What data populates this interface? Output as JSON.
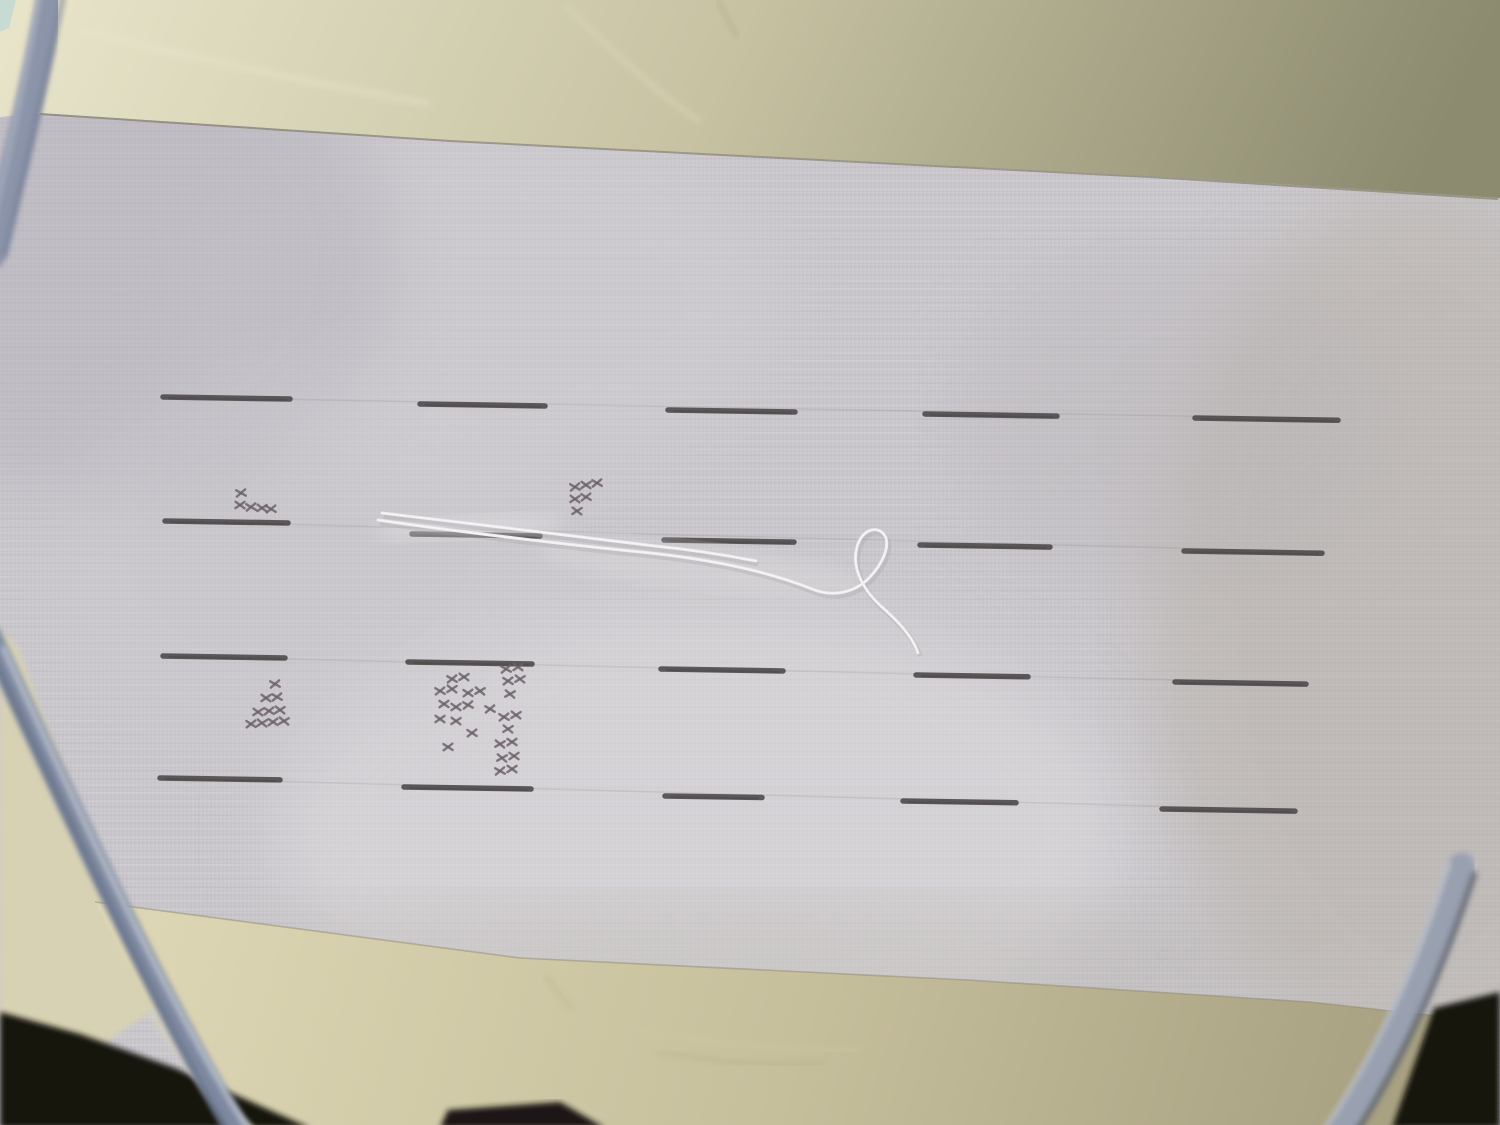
{
  "scene": {
    "description": "photograph of cross-stitch aida fabric in an embroidery hoop with stitched grid dashes, small cross-stitch motifs and a loose white thread",
    "canvas": {
      "width": 1500,
      "height": 1125
    },
    "colors": {
      "aida_base": "#cac7cc",
      "dash": "#4c4749",
      "faint_guide": "#6a6368",
      "cross_stitch": "#6b6068",
      "thread": "#ecebec",
      "thread_core": "#f7f6f7",
      "thread_shadow": "#a29da6",
      "cream_left_bg": "#d8d2b4",
      "corner_patch": "#c8dbd2",
      "aida_edge_line": "#7a7560",
      "tape_edge_line": "#8f8a6e"
    },
    "aida_highlights": [
      {
        "cx": 700,
        "cy": 830,
        "rx": 430,
        "ry": 230,
        "fill": "#dfdcdf",
        "opacity": 0.55
      },
      {
        "cx": 470,
        "cy": 300,
        "rx": 310,
        "ry": 190,
        "fill": "#d3d0d5",
        "opacity": 0.4
      },
      {
        "cx": 130,
        "cy": 260,
        "rx": 270,
        "ry": 250,
        "fill": "#b3b0ba",
        "opacity": 0.45
      },
      {
        "cx": 1420,
        "cy": 620,
        "rx": 270,
        "ry": 430,
        "fill": "#b7b1a6",
        "opacity": 0.5
      },
      {
        "cx": 1180,
        "cy": 420,
        "rx": 220,
        "ry": 170,
        "fill": "#bab6b9",
        "opacity": 0.35
      },
      {
        "cx": 770,
        "cy": 965,
        "rx": 570,
        "ry": 65,
        "fill": "#b2ada2",
        "opacity": 0.28
      },
      {
        "cx": 300,
        "cy": 560,
        "rx": 260,
        "ry": 200,
        "fill": "#cfccd1",
        "opacity": 0.35
      }
    ],
    "grid": {
      "dash_width": 5.5,
      "dash_slope": 0.016,
      "faint_opacity": 0.13,
      "rows": [
        {
          "dashes": [
            [
              163,
              290,
              397
            ],
            [
              420,
              545,
              404
            ],
            [
              668,
              795,
              410
            ],
            [
              925,
              1057,
              414
            ],
            [
              1195,
              1338,
              418
            ]
          ]
        },
        {
          "dashes": [
            [
              165,
              288,
              521
            ],
            [
              412,
              540,
              534
            ],
            [
              664,
              794,
              540
            ],
            [
              920,
              1050,
              545
            ],
            [
              1184,
              1322,
              551
            ]
          ]
        },
        {
          "dashes": [
            [
              163,
              285,
              656
            ],
            [
              408,
              532,
              662
            ],
            [
              661,
              783,
              669
            ],
            [
              916,
              1028,
              675
            ],
            [
              1175,
              1306,
              682
            ]
          ]
        },
        {
          "dashes": [
            [
              160,
              280,
              778
            ],
            [
              404,
              531,
              787
            ],
            [
              665,
              762,
              796
            ],
            [
              903,
              1016,
              801
            ],
            [
              1162,
              1295,
              809
            ]
          ]
        }
      ],
      "faint_lines": [
        [
          163,
          397,
          1338,
          419
        ],
        [
          165,
          521,
          1322,
          552
        ],
        [
          163,
          656,
          1306,
          683
        ],
        [
          160,
          778,
          1295,
          810
        ]
      ]
    },
    "motifs": [
      {
        "name": "small-cluster-band1-col1",
        "crosses": [
          [
            241,
            493
          ],
          [
            240,
            505
          ],
          [
            251,
            507
          ],
          [
            262,
            508
          ],
          [
            271,
            509
          ]
        ]
      },
      {
        "name": "small-flag-band1-col3",
        "crosses": [
          [
            575,
            487
          ],
          [
            586,
            485
          ],
          [
            597,
            483
          ],
          [
            575,
            499
          ],
          [
            586,
            497
          ],
          [
            577,
            511
          ]
        ]
      },
      {
        "name": "tree-band2-col1",
        "crosses": [
          [
            275,
            684
          ],
          [
            266,
            698
          ],
          [
            277,
            697
          ],
          [
            258,
            712
          ],
          [
            269,
            711
          ],
          [
            280,
            710
          ],
          [
            251,
            724
          ],
          [
            262,
            723
          ],
          [
            273,
            722
          ],
          [
            284,
            721
          ]
        ]
      },
      {
        "name": "scatter-band2-col2",
        "crosses": [
          [
            506,
            669
          ],
          [
            518,
            667
          ],
          [
            452,
            679
          ],
          [
            464,
            677
          ],
          [
            440,
            691
          ],
          [
            452,
            689
          ],
          [
            508,
            681
          ],
          [
            520,
            679
          ],
          [
            468,
            693
          ],
          [
            480,
            691
          ],
          [
            444,
            704
          ],
          [
            510,
            694
          ],
          [
            456,
            707
          ],
          [
            468,
            705
          ],
          [
            440,
            719
          ],
          [
            490,
            709
          ],
          [
            456,
            721
          ],
          [
            504,
            717
          ],
          [
            516,
            715
          ],
          [
            472,
            733
          ],
          [
            508,
            729
          ],
          [
            448,
            747
          ],
          [
            500,
            744
          ],
          [
            512,
            742
          ],
          [
            502,
            758
          ],
          [
            514,
            756
          ],
          [
            500,
            771
          ],
          [
            512,
            769
          ]
        ]
      }
    ],
    "thread": {
      "strands": [
        "M378,520 C460,532 570,545 650,553 C722,561 772,573 812,589 C834,598 856,592 870,577 C882,564 889,549 886,538",
        "M886,538 C880,524 862,528 857,547 C851,569 864,591 883,608 C901,624 913,638 918,653",
        "M382,513 C470,523 575,537 655,546 C695,550 725,555 756,561"
      ],
      "sheens": [
        {
          "cx": 470,
          "cy": 527,
          "rx": 95,
          "ry": 11,
          "fill": "#e3e1e3",
          "opacity": 0.5,
          "rotate": -3
        },
        {
          "cx": 700,
          "cy": 567,
          "rx": 165,
          "ry": 22,
          "fill": "#dcd9dc",
          "opacity": 0.45,
          "rotate": 6
        }
      ]
    },
    "background_top": {
      "polygon": "0,0 1500,0 1500,198 1150,176 450,140 40,113 0,117",
      "gradient": [
        "#e9e5cb",
        "#c6c2a2",
        "#8c8a6f"
      ],
      "edge_line": "M40,114 L450,141 L1150,177 L1498,199",
      "corner_patch": "0,0 16,0 9,28 0,32",
      "folds": [
        {
          "d": "M566,6 C610,50 660,95 700,122",
          "color": "#dcd8ba",
          "w": 6,
          "op": 0.45
        },
        {
          "d": "M718,0 C726,16 734,30 738,38",
          "color": "#9a9678",
          "w": 3,
          "op": 0.4
        },
        {
          "d": "M80,30 C200,60 330,86 430,104",
          "color": "#eae6cc",
          "w": 8,
          "op": 0.35
        }
      ]
    },
    "cream_left": {
      "polygon": "0,630 18,648 152,1010 100,1046 0,1020"
    },
    "tape": {
      "polygon": "95,902 520,958 968,980 1310,1002 1438,1016 1402,1128 240,1128 150,1008",
      "gradient": [
        "#ded8b6",
        "#c6bf9c",
        "#a8a182"
      ],
      "wrinkles": [
        {
          "d": "M545,975 C556,992 566,1002 574,1010",
          "color": "#b3ab86",
          "w": 2.5,
          "op": 0.6
        },
        {
          "d": "M640,1030 C720,1044 792,1052 862,1050",
          "color": "#cfc8a4",
          "w": 3,
          "op": 0.6
        },
        {
          "d": "M658,1052 C720,1062 764,1066 824,1064",
          "color": "#a59c7a",
          "w": 2,
          "op": 0.5
        }
      ]
    },
    "shadow_corners": [
      {
        "polygon": "0,1012 80,1034 175,1068 310,1128 0,1128",
        "fill": "#18120d"
      },
      {
        "polygon": "448,1110 560,1102 605,1128 440,1128",
        "fill": "#1d1712"
      },
      {
        "polygon": "1434,1008 1500,992 1500,1128 1392,1128",
        "fill": "#141210"
      }
    ],
    "hoop": {
      "segments": [
        {
          "main": {
            "d": "M52,-10 C38,70 16,160 -8,255",
            "w": 27,
            "color": "#8b94a9"
          },
          "edges": [
            {
              "d": "M64,-8 C48,72 27,162 4,257",
              "w": 4,
              "color": "#6e7890",
              "op": 0.8
            },
            {
              "d": "M40,-10 C28,68 8,158 -14,250",
              "w": 5,
              "color": "#a9b1c2",
              "op": 0.8
            }
          ]
        },
        {
          "main": {
            "d": "M-10,636 C55,775 150,985 240,1134",
            "w": 23,
            "color": "#7e89a0"
          },
          "edges": [
            {
              "d": "M2,646 C66,784 160,992 250,1132",
              "w": 5,
              "color": "#c6cbd5",
              "op": 0.85
            },
            {
              "d": "M-20,630 C46,770 140,980 230,1136",
              "w": 4,
              "color": "#5d677e",
              "op": 0.8
            }
          ]
        },
        {
          "main": {
            "d": "M1462,866 C1434,952 1398,1042 1338,1134",
            "w": 27,
            "color": "#99a1b1"
          },
          "edges": [
            {
              "d": "M1475,872 C1447,956 1412,1046 1354,1136",
              "w": 6,
              "color": "#5a5f6a",
              "op": 0.8
            },
            {
              "d": "M1449,862 C1421,950 1386,1038 1324,1130",
              "w": 4,
              "color": "#c2c7d0",
              "op": 0.8
            }
          ]
        }
      ],
      "rim_inner_light": {
        "d": "M150,1008 C190,1070 225,1110 252,1132",
        "w": 10,
        "color": "#d6d2c2",
        "op": 0.8
      }
    }
  }
}
